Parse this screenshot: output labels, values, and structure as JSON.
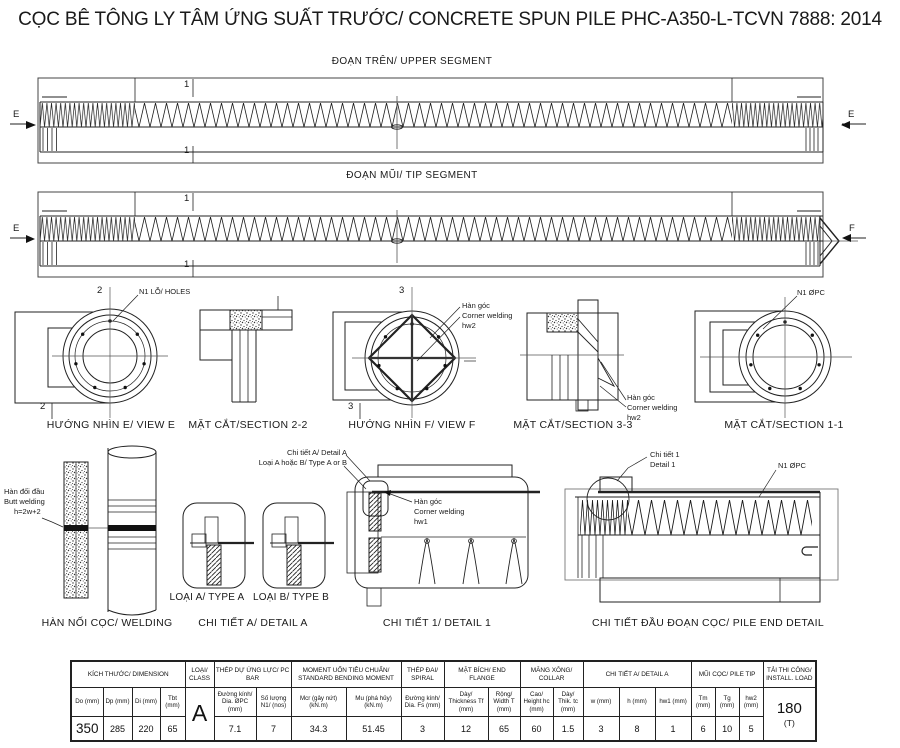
{
  "page_title": "CỌC BÊ TÔNG LY TÂM ỨNG SUẤT TRƯỚC/ CONCRETE SPUN PILE PHC-A350-L-TCVN 7888: 2014",
  "upper_segment": {
    "title": "ĐOẠN TRÊN/ UPPER SEGMENT",
    "section_mark_top": "1",
    "section_mark_bottom": "1",
    "view_mark_left": "E",
    "view_mark_right": "E"
  },
  "tip_segment": {
    "title": "ĐOẠN MŨI/ TIP SEGMENT",
    "section_mark_top": "1",
    "section_mark_bottom": "1",
    "view_mark_left": "E",
    "view_mark_right": "F"
  },
  "view_e": {
    "label": "HƯỚNG NHÌN E/ VIEW E",
    "mark_top": "2",
    "mark_bottom": "2",
    "holes_callout": "N1 LỖ/ HOLES"
  },
  "section_2_2": {
    "label": "MẶT CẮT/SECTION 2-2"
  },
  "view_f": {
    "label": "HƯỚNG NHÌN F/ VIEW F",
    "mark_top": "3",
    "mark_bottom": "3",
    "weld_callout": {
      "line1": "Hàn góc",
      "line2": "Corner welding",
      "line3": "hw2"
    }
  },
  "section_3_3": {
    "label": "MẶT CẮT/SECTION 3-3",
    "weld_callout": {
      "line1": "Hàn góc",
      "line2": "Corner welding",
      "line3": "hw2"
    }
  },
  "section_1_1": {
    "label": "MẶT CẮT/SECTION 1-1",
    "pc_bar_callout": "N1 ØPC"
  },
  "welding_detail": {
    "label": "HÀN NỐI CỌC/ WELDING",
    "butt_weld_callout": {
      "line1": "Hàn đối đầu",
      "line2": "Butt welding",
      "line3": "h=2w+2"
    }
  },
  "detail_a": {
    "label": "CHI TIẾT A/ DETAIL A",
    "type_a_label": "LOẠI A/ TYPE A",
    "type_b_label": "LOẠI B/ TYPE B"
  },
  "detail_1": {
    "label": "CHI TIẾT 1/ DETAIL 1",
    "ref_callout": {
      "line1": "Chi tiết A/ Detail A",
      "line2": "Loại A hoặc B/ Type A or B"
    },
    "weld_callout": {
      "line1": "Hàn góc",
      "line2": "Corner welding",
      "line3": "hw1"
    }
  },
  "pile_end_detail": {
    "label": "CHI TIẾT ĐẦU ĐOẠN CỌC/ PILE END DETAIL",
    "detail1_callout": {
      "line1": "Chi tiết 1",
      "line2": "Detail 1"
    },
    "pc_bar_callout": "N1 ØPC"
  },
  "spec_table": {
    "groups": {
      "dimension": "KÍCH THƯỚC/ DIMENSION",
      "class": "LOẠI/ CLASS",
      "pc_bar": "THÉP DỰ ỨNG LỰC/ PC BAR",
      "bending_moment": "MOMENT UỐN TIÊU CHUẨN/ STANDARD BENDING MOMENT",
      "spiral": "THÉP ĐAI/ SPIRAL",
      "end_flange": "MẶT BÍCH/ END FLANGE",
      "collar": "MĂNG XÔNG/ COLLAR",
      "detail_a": "CHI TIẾT A/ DETAIL A",
      "pile_tip": "MŨI CỌC/ PILE TIP",
      "install_load": "TẢI THI CÔNG/ INSTALL. LOAD"
    },
    "columns": [
      {
        "header": "Do (mm)",
        "value": "350"
      },
      {
        "header": "Dp (mm)",
        "value": "285"
      },
      {
        "header": "Di (mm)",
        "value": "220"
      },
      {
        "header": "Tbt (mm)",
        "value": "65"
      },
      {
        "header": "Đường kính/ Dia. ØPC (mm)",
        "value": "7.1"
      },
      {
        "header": "Số lượng N1/ (nos)",
        "value": "7"
      },
      {
        "header": "Mcr (gây nứt) (kN.m)",
        "value": "34.3"
      },
      {
        "header": "Mu (phá hủy) (kN.m)",
        "value": "51.45"
      },
      {
        "header": "Đường kính/ Dia. Fs (mm)",
        "value": "3"
      },
      {
        "header": "Dày/ Thickness Tf (mm)",
        "value": "12"
      },
      {
        "header": "Rộng/ Width T (mm)",
        "value": "65"
      },
      {
        "header": "Cao/ Height hc (mm)",
        "value": "60"
      },
      {
        "header": "Dày/ Thik. tc (mm)",
        "value": "1.5"
      },
      {
        "header": "w (mm)",
        "value": "3"
      },
      {
        "header": "h (mm)",
        "value": "8"
      },
      {
        "header": "hw1 (mm)",
        "value": "1"
      },
      {
        "header": "Tm (mm)",
        "value": "6"
      },
      {
        "header": "Tg (mm)",
        "value": "10"
      },
      {
        "header": "hw2 (mm)",
        "value": "5"
      }
    ],
    "class_value": "A",
    "install_load_value": "180",
    "install_load_unit": "(T)"
  }
}
